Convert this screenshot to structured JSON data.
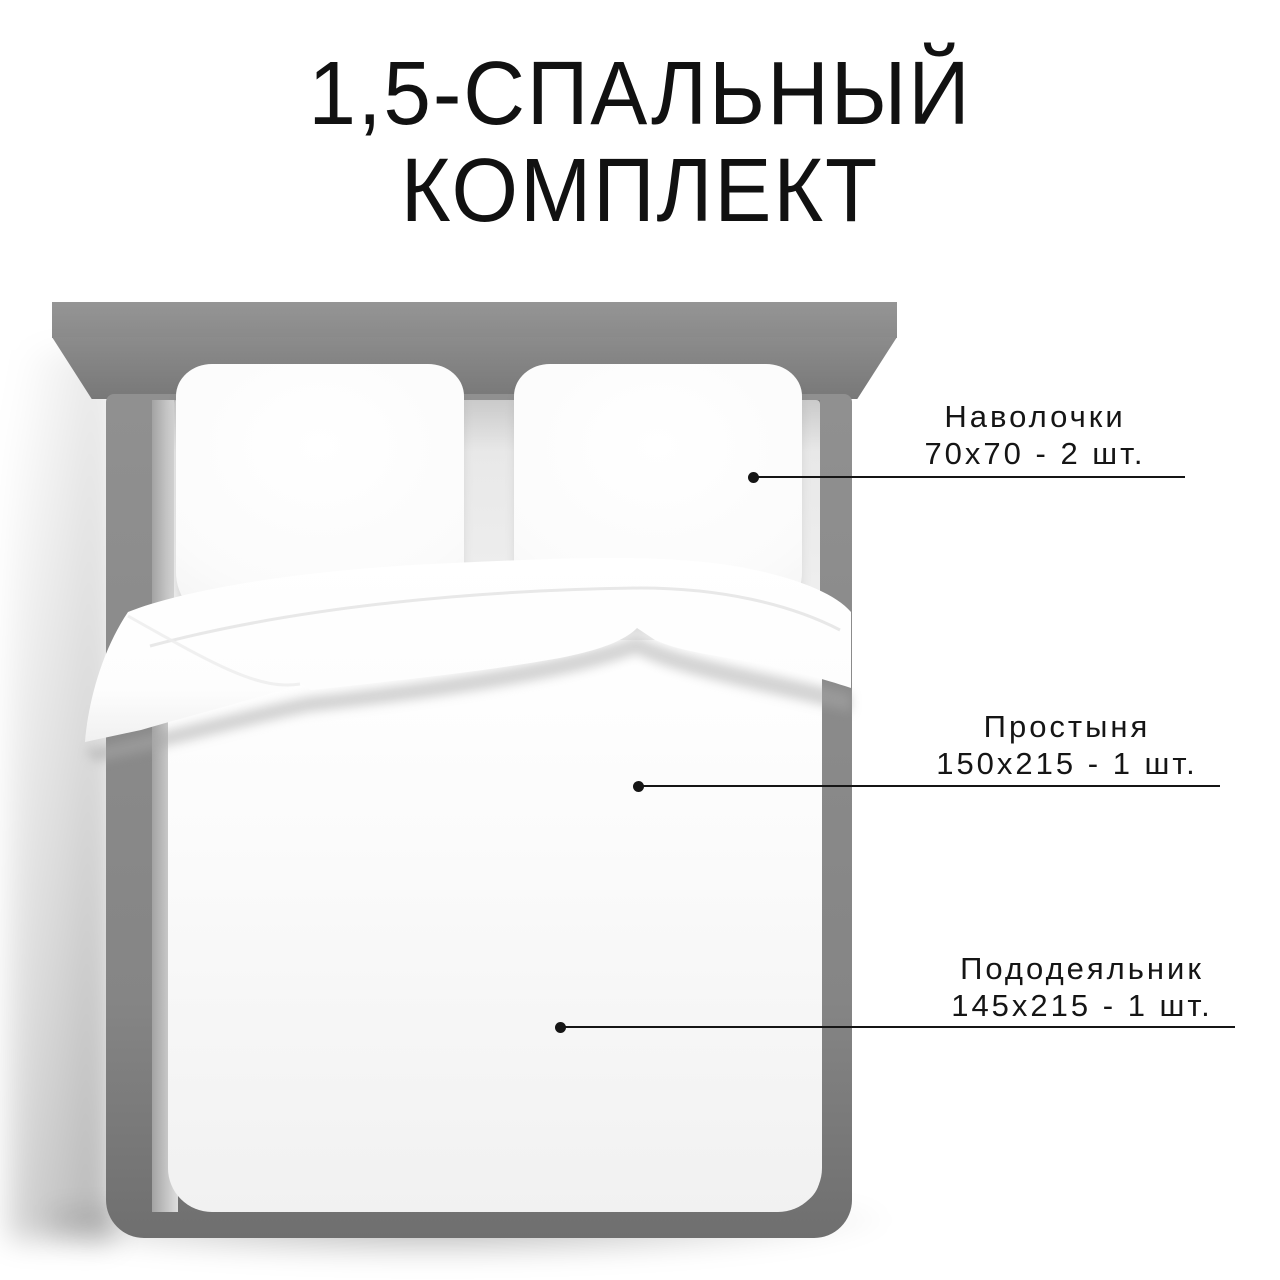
{
  "title": {
    "line1": "1,5-СПАЛЬНЫЙ",
    "line2": "КОМПЛЕКТ"
  },
  "callouts": [
    {
      "label": "Наволочки",
      "spec": "70х70 - 2 шт."
    },
    {
      "label": "Простыня",
      "spec": "150х215 - 1 шт."
    },
    {
      "label": "Пододеяльник",
      "spec": "145х215 - 1 шт."
    }
  ],
  "colors": {
    "background": "#ffffff",
    "text": "#151515",
    "callout_line": "#151515",
    "bed_frame_gray": "#8a8a8a",
    "headboard_gray": "#8f8f8f",
    "linen_white": "#fafafa"
  }
}
